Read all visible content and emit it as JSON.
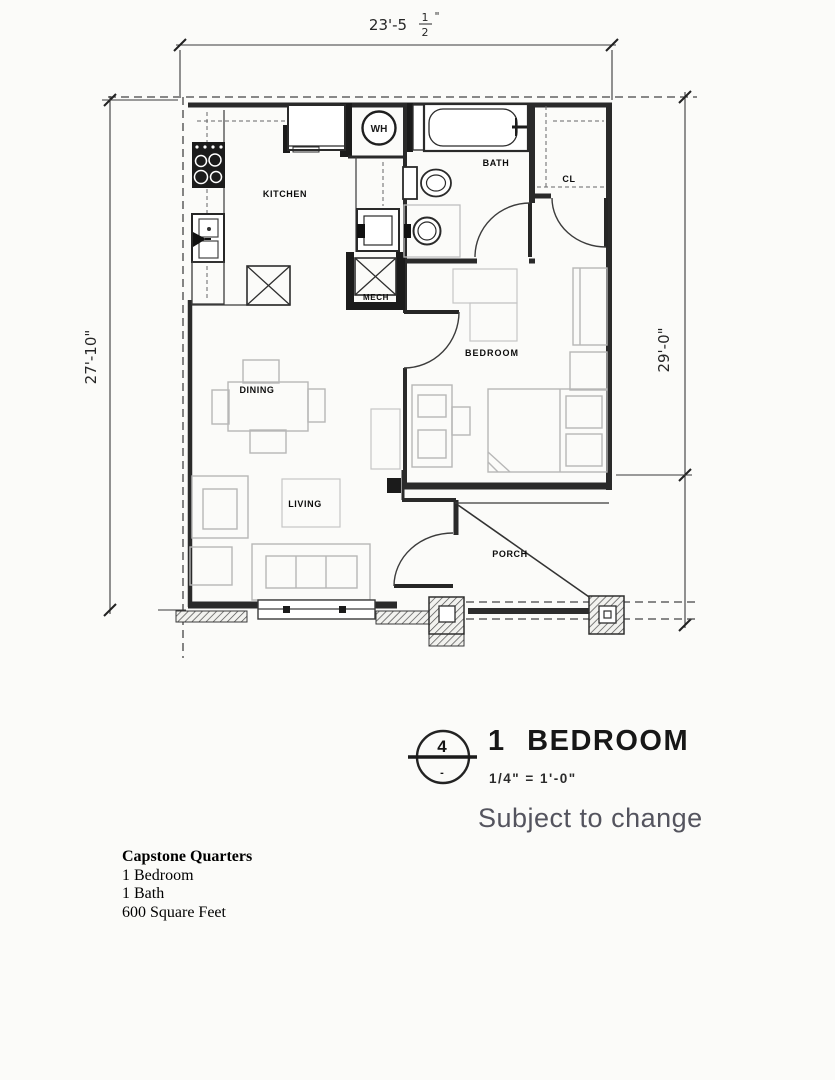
{
  "drawing": {
    "dim_top": {
      "whole": "23'-5",
      "frac_num": "1",
      "frac_den": "2",
      "suffix": "\""
    },
    "dim_left": "27'-10\"",
    "dim_right": "29'-0\"",
    "rooms": {
      "kitchen": "KITCHEN",
      "bath": "BATH",
      "closet": "CL",
      "mech": "MECH",
      "bedroom": "BEDROOM",
      "dining": "DINING",
      "living": "LIVING",
      "porch": "PORCH"
    },
    "fixtures": {
      "water_heater": "WH"
    }
  },
  "title_block": {
    "sheet_number": "4",
    "sheet_mark": "-",
    "plan_name": "1 BEDROOM",
    "scale": "1/4\" = 1'-0\"",
    "disclaimer": "Subject to change"
  },
  "summary": {
    "property": "Capstone Quarters",
    "lines": [
      "1 Bedroom",
      "1 Bath",
      "600 Square Feet"
    ]
  },
  "colors": {
    "ink": "#2a2a2a",
    "furniture": "#b7b7b7",
    "disclaimer_text": "#54545e",
    "background": "#fbfbf9"
  }
}
